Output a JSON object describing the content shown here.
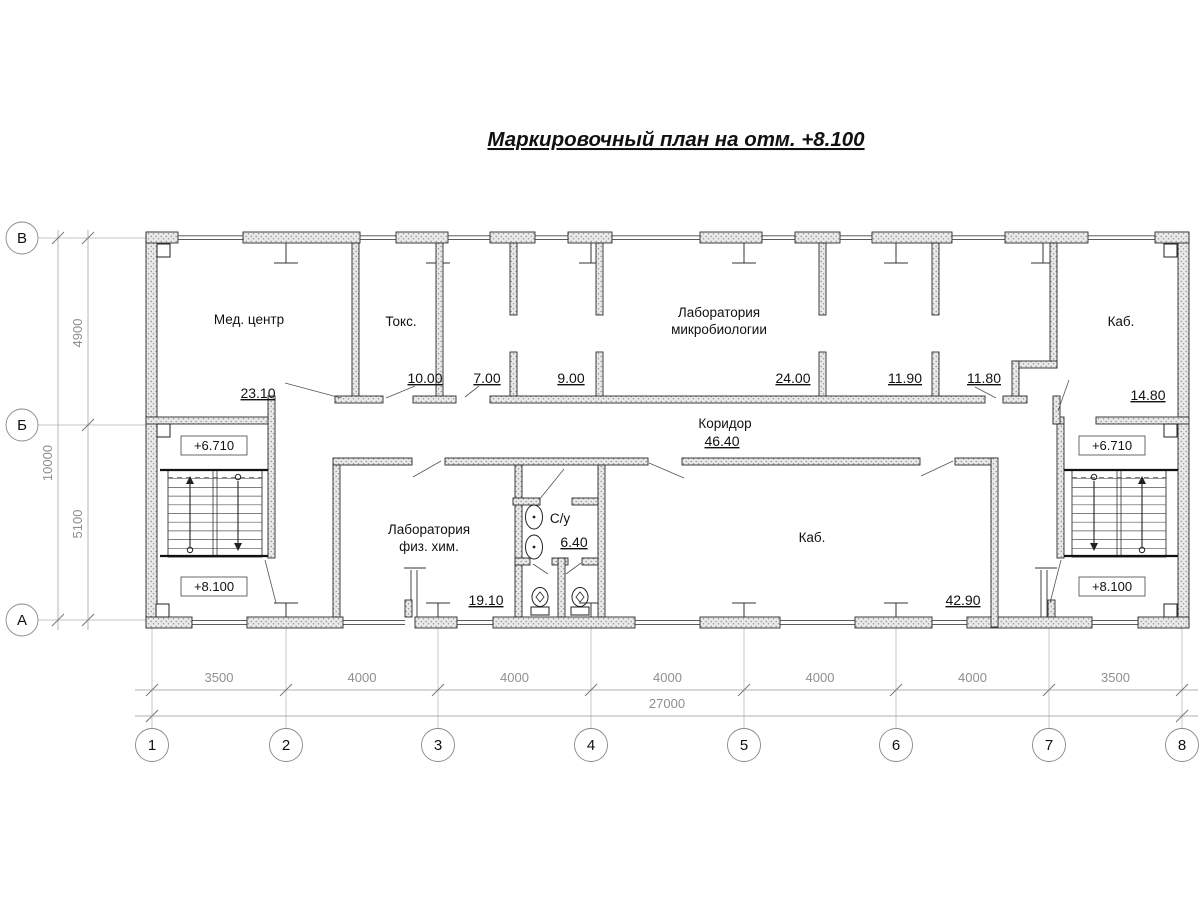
{
  "title": "Маркировочный план на отм. +8.100",
  "axes": {
    "cols": [
      "1",
      "2",
      "3",
      "4",
      "5",
      "6",
      "7",
      "8"
    ],
    "rows": [
      "В",
      "Б",
      "А"
    ]
  },
  "dims": {
    "bottom": [
      "3500",
      "4000",
      "4000",
      "4000",
      "4000",
      "4000",
      "3500"
    ],
    "bottom_total": "27000",
    "left_top": "4900",
    "left_bottom": "5100",
    "left_total": "10000"
  },
  "levels": {
    "upper": "+6.710",
    "main": "+8.100"
  },
  "rooms": {
    "med_center": {
      "name": "Мед. центр",
      "area": "23.10"
    },
    "toks": {
      "name": "Токс.",
      "area": "10.00"
    },
    "room_7": {
      "area": "7.00"
    },
    "room_9": {
      "area": "9.00"
    },
    "microbio": {
      "name_line1": "Лаборатория",
      "name_line2": "микробиологии",
      "area": "24.00"
    },
    "room_1190": {
      "area": "11.90"
    },
    "room_1180": {
      "area": "11.80"
    },
    "kab_top": {
      "name": "Каб.",
      "area": "14.80"
    },
    "corridor": {
      "name": "Коридор",
      "area": "46.40"
    },
    "fizhim": {
      "name_line1": "Лаборатория",
      "name_line2": "физ. хим.",
      "area": "19.10"
    },
    "su": {
      "name": "С/у",
      "area": "6.40"
    },
    "kab_main": {
      "name": "Каб.",
      "area": "42.90"
    }
  },
  "colors": {
    "wall_fill": "#e9e9e9",
    "wall_stroke": "#2b2b2b",
    "dim_gray": "#8f8f8f"
  }
}
